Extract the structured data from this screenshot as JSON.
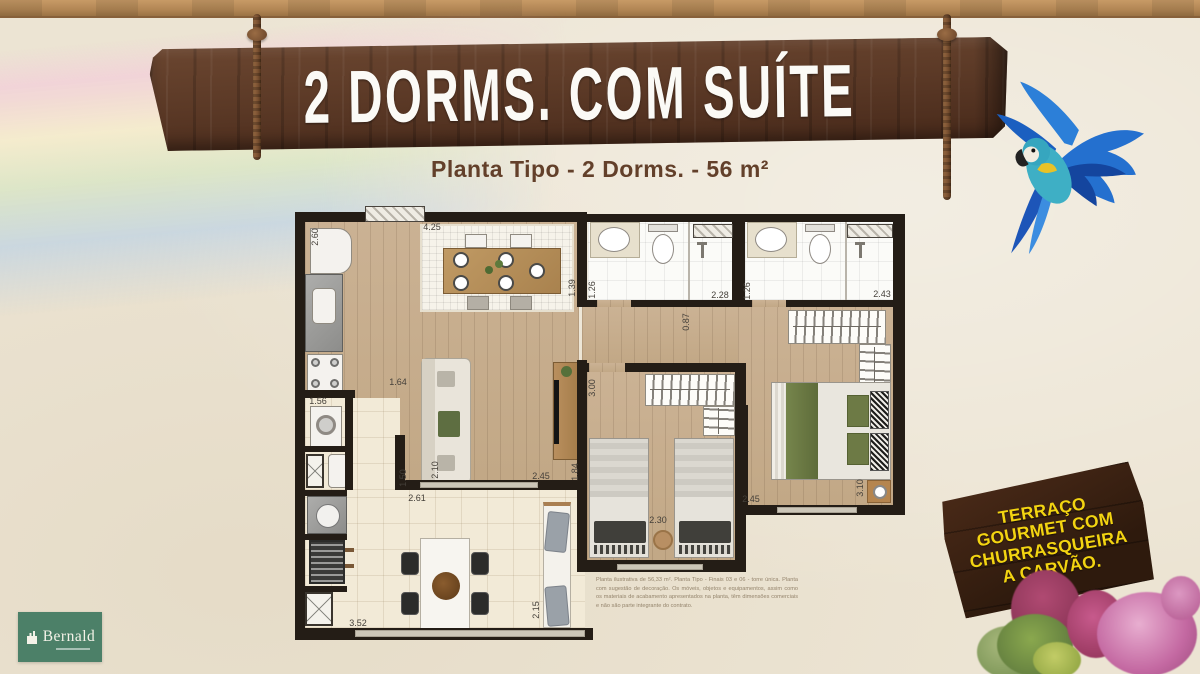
{
  "header": {
    "title": "2 DORMS. COM SUÍTE",
    "subtitle": "Planta Tipo - 2 Dorms. - 56 m²"
  },
  "floorplan": {
    "dimensions": [
      {
        "value": "2.60",
        "x": 20,
        "y": 29,
        "vertical": true
      },
      {
        "value": "4.25",
        "x": 137,
        "y": 19,
        "vertical": false
      },
      {
        "value": "1.39",
        "x": 277,
        "y": 80,
        "vertical": true
      },
      {
        "value": "1.26",
        "x": 297,
        "y": 82,
        "vertical": true
      },
      {
        "value": "2.28",
        "x": 425,
        "y": 87,
        "vertical": false
      },
      {
        "value": "1.26",
        "x": 452,
        "y": 83,
        "vertical": true
      },
      {
        "value": "2.43",
        "x": 587,
        "y": 86,
        "vertical": false
      },
      {
        "value": "0.87",
        "x": 391,
        "y": 114,
        "vertical": true
      },
      {
        "value": "3.00",
        "x": 297,
        "y": 180,
        "vertical": true
      },
      {
        "value": "1.64",
        "x": 103,
        "y": 174,
        "vertical": false
      },
      {
        "value": "1.56",
        "x": 23,
        "y": 193,
        "vertical": false
      },
      {
        "value": "2.10",
        "x": 140,
        "y": 262,
        "vertical": true
      },
      {
        "value": "2.45",
        "x": 246,
        "y": 268,
        "vertical": false
      },
      {
        "value": "1.84",
        "x": 280,
        "y": 264,
        "vertical": true
      },
      {
        "value": "1.50",
        "x": 108,
        "y": 270,
        "vertical": true
      },
      {
        "value": "2.61",
        "x": 122,
        "y": 290,
        "vertical": false
      },
      {
        "value": "2.30",
        "x": 363,
        "y": 312,
        "vertical": false
      },
      {
        "value": "2.45",
        "x": 456,
        "y": 291,
        "vertical": false
      },
      {
        "value": "3.10",
        "x": 565,
        "y": 280,
        "vertical": true
      },
      {
        "value": "3.52",
        "x": 63,
        "y": 415,
        "vertical": false
      },
      {
        "value": "2.15",
        "x": 241,
        "y": 402,
        "vertical": true
      }
    ],
    "disclaimer": "Planta ilustrativa de 56,33 m². Planta Tipo - Finais 03 e 06 - torre única. Planta com sugestão de decoração. Os móveis, objetos e equipamentos, assim como os materiais de acabamento apresentados na planta, têm dimensões comerciais e não são parte integrante do contrato."
  },
  "terrace_sign": {
    "lines": [
      "TERRAÇO",
      "GOURMET COM",
      "CHURRASQUEIRA",
      "A CARVÃO."
    ],
    "text_color": "#f3d411"
  },
  "logo": {
    "name": "Bernald"
  },
  "colors": {
    "background": "#ece4d3",
    "plank_brown": "#5b3926",
    "subtitle_brown": "#63402a",
    "logo_green": "#4c8068",
    "wall_black": "#241d16"
  }
}
